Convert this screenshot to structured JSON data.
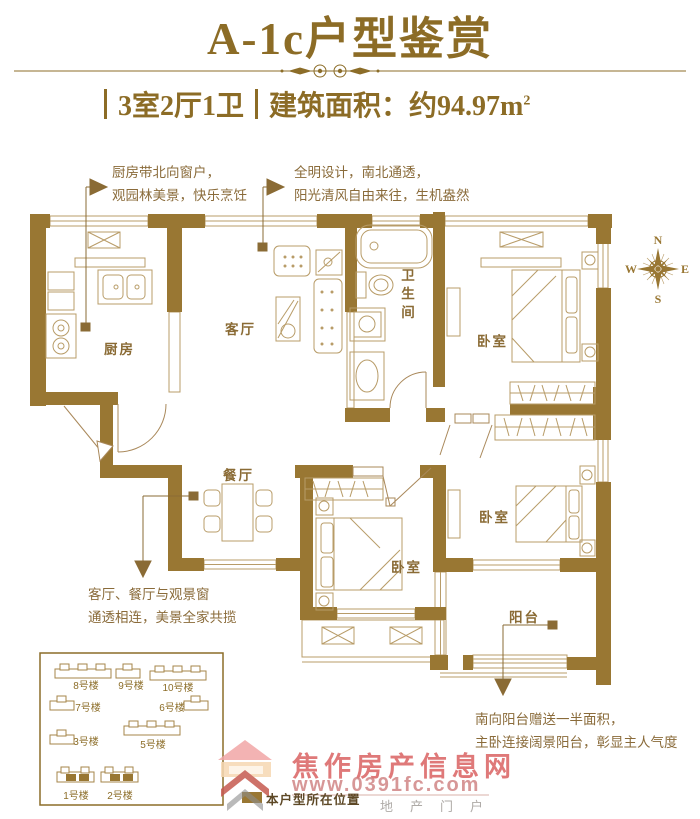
{
  "header": {
    "title": "A-1c户型鉴赏",
    "spec": "3室2厅1卫",
    "area_label": "建筑面积：约94.97m",
    "area_sup": "2"
  },
  "annotations": {
    "kitchen": {
      "line1": "厨房带北向窗户，",
      "line2": "观园林美景，快乐烹饪"
    },
    "daylight": {
      "line1": "全明设计，南北通透，",
      "line2": "阳光清风自由来往，生机盎然"
    },
    "living": {
      "line1": "客厅、餐厅与观景窗",
      "line2": "通透相连，美景全家共揽"
    },
    "balcony": {
      "line1": "南向阳台赠送一半面积，",
      "line2": "主卧连接阔景阳台，彰显主人气度"
    }
  },
  "rooms": {
    "kitchen": "厨房",
    "living": "客厅",
    "bath": "卫生间",
    "bedroom_north": "卧室",
    "bedroom_east": "卧室",
    "bedroom_south": "卧室",
    "dining": "餐厅",
    "balcony": "阳台"
  },
  "compass": {
    "n": "N",
    "e": "E",
    "s": "S",
    "w": "W"
  },
  "siteplan": {
    "b1": "1号楼",
    "b2": "2号楼",
    "b3": "3号楼",
    "b5": "5号楼",
    "b6": "6号楼",
    "b7": "7号楼",
    "b8": "8号楼",
    "b9": "9号楼",
    "b10": "10号楼",
    "legend": "本户型所在位置"
  },
  "watermark": {
    "name": "焦作房产信息网",
    "url": "www.0391fc.com",
    "tagline": "地产门户"
  },
  "colors": {
    "wall": "#997733",
    "line": "#b89c68",
    "accent": "#8c6c26",
    "watermark_red": "#d85c5c"
  }
}
